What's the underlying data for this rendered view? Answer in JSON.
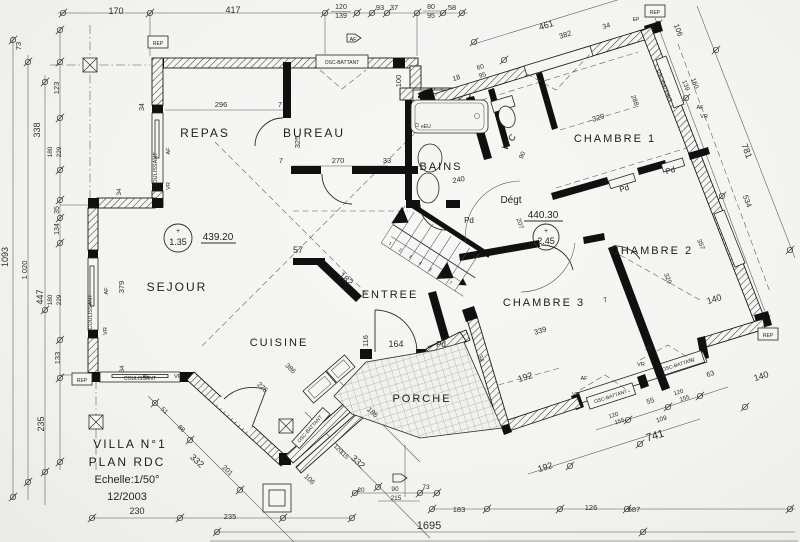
{
  "title": {
    "l1": "VILLA  N°1",
    "l2": "PLAN  RDC",
    "l3": "Echelle:1/50°",
    "l4": "12/2003"
  },
  "rooms": {
    "repas": "REPAS",
    "bureau": "BUREAU",
    "bains": "BAINS",
    "wc": "WC",
    "degt": "Dégt",
    "chambre1": "CHAMBRE 1",
    "chambre2": "CHAMBRE 2",
    "chambre3": "CHAMBRE 3",
    "sejour": "SEJOUR",
    "cuisine": "CUISINE",
    "entree": "ENTREE",
    "porche": "PORCHE"
  },
  "levels": {
    "sejour": {
      "plus": "+",
      "value": "1.35",
      "altitude": "439.20"
    },
    "degt": {
      "plus": "+",
      "value": "2.45",
      "altitude": "440.30"
    }
  },
  "labels": {
    "coulissant": "COULISSANT",
    "osc": "OSC-BATTANT",
    "af": "AF",
    "vr": "VR",
    "pd": "Pd",
    "rep": "REP",
    "ep": "EP",
    "eu": "eEU"
  },
  "stair": {
    "steps": [
      "1",
      "2",
      "3",
      "4",
      "5",
      "6",
      "7"
    ]
  },
  "dims": [
    "170",
    "417",
    "120",
    "139",
    "93",
    "37",
    "80",
    "95",
    "58",
    "461",
    "382",
    "34",
    "18",
    "60",
    "95",
    "106",
    "139",
    "160",
    "781",
    "534",
    "288",
    "73",
    "123",
    "338",
    "180",
    "229",
    "1093",
    "1 020",
    "447",
    "180",
    "229",
    "35",
    "134",
    "133",
    "235",
    "34",
    "296",
    "7",
    "325",
    "270",
    "33",
    "7",
    "100",
    "240",
    "90",
    "207",
    "379",
    "34",
    "34",
    "57",
    "182",
    "164",
    "116",
    "386",
    "225",
    "51",
    "88",
    "332",
    "201",
    "106",
    "120",
    "115",
    "332",
    "186",
    "230",
    "235",
    "1695",
    "183",
    "126",
    "687",
    "20",
    "90",
    "215",
    "73",
    "329",
    "329",
    "357",
    "140",
    "339",
    "7",
    "192",
    "34",
    "192",
    "741",
    "109",
    "55",
    "63",
    "120",
    "155",
    "120",
    "155",
    "140"
  ]
}
